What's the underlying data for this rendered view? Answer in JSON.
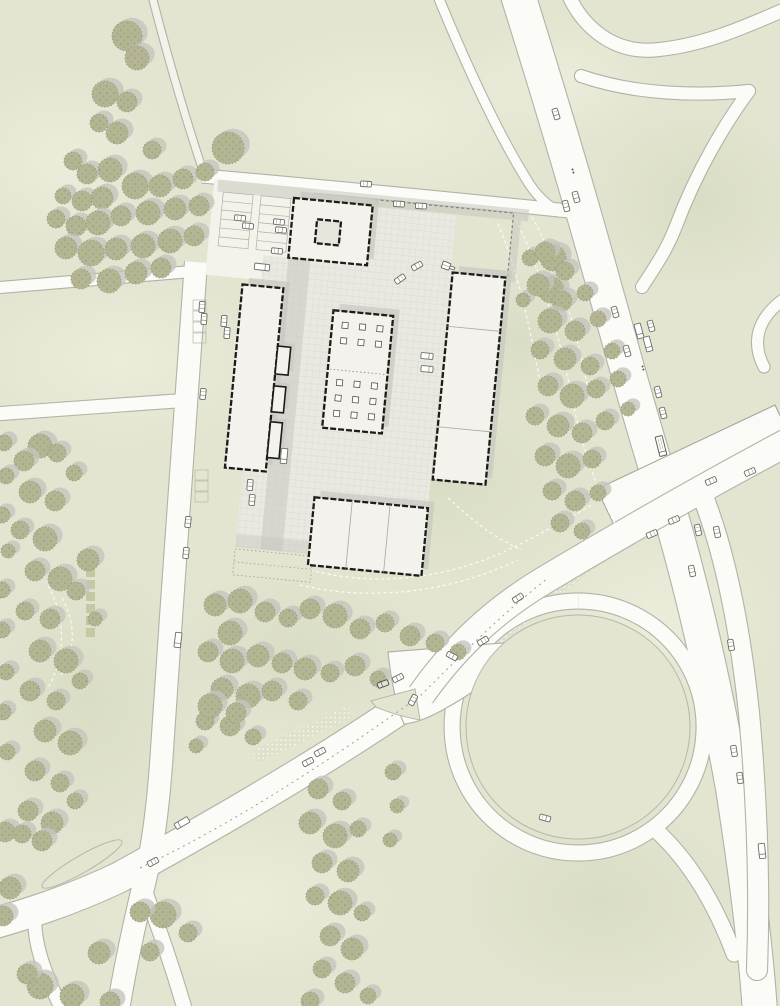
{
  "meta": {
    "kind": "architectural-site-plan",
    "width": 780,
    "height": 1006
  },
  "colors": {
    "grass": "#e3e5d1",
    "grassLight": "#edeedd",
    "grassDark": "#d6d9bf",
    "roadFill": "#fbfbf8",
    "roadEdge": "#b2b2a7",
    "pathFill": "#f3f3eb",
    "plazaFill": "#e9e9e1",
    "plazaLine": "#d9d8cf",
    "grayStrip": "#c6c6be",
    "shadow": "#c8c8c0",
    "buildingFill": "#f3f2ec",
    "buildingEdge": "#1c1c1a",
    "innerLine": "#a9a9a0",
    "treeFill": "#b4b593",
    "treeDot": "#8b8d6e",
    "treeShadow": "#c5c4bd",
    "treeEdge": "#9a9c7e",
    "carFill": "#ffffff",
    "carEdge": "#6e6e66",
    "fence": "#85857d",
    "dashWhite": "#ffffff",
    "cobbleDot": "#f8f8f2",
    "islandEdge": "#b7b7ac",
    "deckFill": "#fafaf6",
    "deckEdge": "#a6a69c"
  },
  "mottle": {
    "light": [
      [
        390,
        120,
        170,
        90
      ],
      [
        120,
        360,
        150,
        85
      ],
      [
        660,
        620,
        120,
        90
      ],
      [
        240,
        900,
        150,
        80
      ],
      [
        560,
        80,
        95,
        60
      ],
      [
        60,
        160,
        110,
        90
      ]
    ],
    "dark": [
      [
        440,
        480,
        180,
        120
      ],
      [
        90,
        700,
        120,
        160
      ],
      [
        600,
        900,
        160,
        110
      ],
      [
        700,
        200,
        120,
        100
      ],
      [
        300,
        650,
        140,
        90
      ],
      [
        520,
        340,
        110,
        80
      ]
    ]
  },
  "cobble_bands": [
    {
      "d": "M 660,510 C 615,545 560,585 520,618 C 495,640 470,665 450,688",
      "w": 14
    },
    {
      "d": "M 350,712 C 318,728 285,742 255,757",
      "w": 13
    }
  ],
  "roads": [
    {
      "name": "highway-main",
      "layer": 1,
      "d": "M 517,-8 C 543,75 572,170 603,282 C 622,350 645,435 668,506 C 690,580 712,672 733,788 C 747,878 756,952 760,1012",
      "w": 34
    },
    {
      "name": "service-road",
      "layer": 1,
      "d": "M 437,-6 C 460,50 495,130 530,185 C 541,201 551,208 562,213",
      "w": 9
    },
    {
      "name": "ramp-s-curve",
      "layer": 1,
      "d": "M 568,-6 C 583,28 614,53 654,50 C 704,46 749,25 786,9",
      "w": 13
    },
    {
      "name": "ramp-east-upper",
      "layer": 1,
      "cap": "round",
      "d": "M 581,76 C 636,95 700,96 749,91",
      "w": 12
    },
    {
      "name": "ramp-east-lower",
      "layer": 1,
      "cap": "round",
      "d": "M 749,91 C 726,122 697,170 676,226 C 666,252 654,268 642,287",
      "w": 12
    },
    {
      "name": "ramp-edge-blip",
      "layer": 1,
      "cap": "round",
      "d": "M 787,297 C 757,317 751,342 764,367",
      "w": 11
    },
    {
      "name": "access-road-north",
      "layer": 1,
      "d": "M 202,176 C 320,186 450,199 569,211",
      "w": 13
    },
    {
      "name": "footpath-northwest",
      "layer": 1,
      "fillColor": "#f3f3eb",
      "d": "M 152,-4 C 168,58 186,120 204,174",
      "w": 7
    },
    {
      "name": "west-link-upper",
      "layer": 1,
      "d": "M -6,288 L 198,271",
      "w": 11
    },
    {
      "name": "west-link-lower",
      "layer": 1,
      "d": "M -6,414 L 190,400",
      "w": 13
    },
    {
      "name": "west-road",
      "layer": 1,
      "d": "M 196,262 C 188,390 173,580 162,750 C 158,812 152,852 143,888 C 133,930 125,968 118,1010",
      "w": 22
    },
    {
      "name": "south-fork-road",
      "layer": 1,
      "cap": "round",
      "d": "M 143,886 C 158,925 171,962 185,1010",
      "w": 14
    },
    {
      "name": "boulevard",
      "layer": 1,
      "d": "M 422,694 C 320,765 200,833 118,878 C 65,903 20,916 -8,924",
      "w": 30
    },
    {
      "name": "boulevard-corner-branch",
      "layer": 1,
      "cap": "round",
      "d": "M 36,905 C 30,940 46,975 62,1010",
      "w": 13
    },
    {
      "name": "ring-road",
      "layer": 1,
      "d": "M 578,601 a 126,126 0 1 0 0.2,0",
      "w": 15
    },
    {
      "name": "ring-exit-ramp",
      "layer": 1,
      "cap": "round",
      "d": "M 658,832 C 692,864 716,906 734,954",
      "w": 15
    },
    {
      "name": "fork-apron",
      "layer": 1,
      "type": "fill",
      "d": "M 388,652 L 540,640 C 516,662 478,690 448,707 C 431,717 416,723 404,724 C 397,708 391,681 388,652 Z"
    },
    {
      "name": "bridge-road",
      "layer": 2,
      "d": "M 788,442 C 700,489 618,536 543,581 C 490,613 452,651 421,695",
      "w": 27
    },
    {
      "name": "bridge-south-ramp",
      "layer": 2,
      "cap": "round",
      "d": "M 700,489 C 728,557 742,646 749,713 C 757,800 760,888 757,970",
      "w": 20
    }
  ],
  "bridge_deck": {
    "points": "597,489 775,405 793,443 615,527"
  },
  "islands": [
    {
      "type": "circle",
      "name": "loop-island",
      "cx": 578,
      "cy": 727,
      "r": 112
    },
    {
      "type": "ellipse",
      "name": "median-island",
      "cx": 82,
      "cy": 864,
      "rx": 46,
      "ry": 8.5,
      "rot": -30
    },
    {
      "type": "path",
      "name": "triangle-island",
      "d": "M 371,701 L 415,689 L 420,720 Q 394,715 376,707 Z"
    }
  ],
  "road_marks": [
    {
      "name": "boulevard-centerline",
      "d": "M 140,868 C 240,820 330,760 420,696 C 458,659 492,622 548,578",
      "dash": "2 4",
      "color": "#9f9f94",
      "w": 1
    }
  ],
  "decor_dashes": [
    {
      "d": "M 516,220 C 540,268 558,330 572,398 C 582,448 598,492 616,526"
    },
    {
      "d": "M 498,224 C 518,270 531,332 543,398"
    },
    {
      "d": "M 532,217 C 558,262 576,330 590,398"
    },
    {
      "d": "M 310,570 C 380,588 450,578 512,548 C 545,532 572,516 592,505"
    },
    {
      "d": "M 300,585 C 372,602 452,592 518,560"
    },
    {
      "d": "M 62,598 C 76,622 76,652 60,676"
    },
    {
      "d": "M 48,586 C 66,616 66,656 48,688"
    },
    {
      "d": "M 448,498 C 472,520 494,538 522,550"
    }
  ],
  "campus": {
    "rotation": 5.5,
    "cx": 380,
    "cy": 380,
    "pads": [
      [
        196,
        196,
        100,
        96
      ]
    ],
    "plaza_rects": [
      [
        356,
        207,
        84,
        60
      ],
      [
        252,
        267,
        188,
        240
      ],
      [
        252,
        460,
        76,
        100
      ]
    ],
    "gray_rects": [
      [
        200,
        196,
        312,
        12,
        0.55
      ],
      [
        497,
        208,
        8,
        62,
        0.5
      ],
      [
        277,
        267,
        22,
        293,
        0.5
      ],
      [
        252,
        547,
        78,
        13,
        0.45
      ]
    ],
    "fence_points": "358,201 497,201 497,265",
    "plot_rect": [
      252,
      562,
      78,
      26
    ],
    "buildings": [
      {
        "name": "north-courtyard-building",
        "x": 277,
        "y": 207,
        "w": 79,
        "h": 60
      },
      {
        "name": "north-courtyard-void",
        "x": 302,
        "y": 226,
        "w": 24,
        "h": 24,
        "fill": "#e7e6db",
        "noshadow": true
      },
      {
        "name": "west-slab-building",
        "x": 234,
        "y": 298,
        "w": 41,
        "h": 184
      },
      {
        "name": "central-pavilion",
        "x": 327,
        "y": 315,
        "w": 60,
        "h": 118
      },
      {
        "name": "east-slab-building",
        "x": 442,
        "y": 266,
        "w": 53,
        "h": 208,
        "inner_h": [
          320,
          421
        ]
      },
      {
        "name": "south-building",
        "x": 326,
        "y": 503,
        "w": 114,
        "h": 68,
        "inner_v": [
          364,
          402
        ]
      }
    ],
    "annexes": [
      [
        275,
        356,
        13,
        28
      ],
      [
        275,
        396,
        12,
        26
      ],
      [
        275,
        432,
        12,
        36
      ]
    ],
    "columns": {
      "xs": [
        337,
        354.5,
        372
      ],
      "ys_top": [
        326,
        341.5
      ],
      "ys_bot": [
        383.5,
        399,
        414.5
      ],
      "size": 6
    },
    "pavilion_divider": [
      329,
      374,
      385,
      374
    ],
    "parking_banks": [
      [
        206,
        208,
        30,
        54,
        6
      ],
      [
        244,
        208,
        30,
        54,
        6
      ]
    ],
    "hedges": [
      [
        86,
        556
      ],
      [
        86,
        568
      ],
      [
        86,
        580
      ],
      [
        86,
        592
      ],
      [
        86,
        604
      ],
      [
        86,
        616
      ],
      [
        86,
        628
      ]
    ],
    "bays": [
      [
        193,
        300
      ],
      [
        193,
        311
      ],
      [
        193,
        322
      ],
      [
        193,
        333
      ],
      [
        195,
        470
      ],
      [
        195,
        481
      ],
      [
        195,
        492
      ]
    ]
  },
  "trees": [
    [
      127,
      36,
      15
    ],
    [
      137,
      58,
      12
    ],
    [
      105,
      94,
      13
    ],
    [
      127,
      102,
      10
    ],
    [
      99,
      123,
      9
    ],
    [
      117,
      133,
      11
    ],
    [
      152,
      150,
      9
    ],
    [
      73,
      161,
      9
    ],
    [
      87,
      174,
      10
    ],
    [
      110,
      170,
      12
    ],
    [
      135,
      186,
      13
    ],
    [
      63,
      196,
      8
    ],
    [
      82,
      201,
      10
    ],
    [
      102,
      198,
      11
    ],
    [
      160,
      186,
      11
    ],
    [
      183,
      179,
      10
    ],
    [
      228,
      148,
      16
    ],
    [
      205,
      172,
      9
    ],
    [
      56,
      219,
      9
    ],
    [
      76,
      226,
      10
    ],
    [
      98,
      223,
      12
    ],
    [
      121,
      216,
      10
    ],
    [
      148,
      213,
      12
    ],
    [
      175,
      209,
      11
    ],
    [
      199,
      206,
      10
    ],
    [
      66,
      248,
      11
    ],
    [
      91,
      253,
      13
    ],
    [
      116,
      249,
      11
    ],
    [
      143,
      246,
      12
    ],
    [
      170,
      241,
      12
    ],
    [
      194,
      236,
      10
    ],
    [
      81,
      279,
      10
    ],
    [
      109,
      281,
      12
    ],
    [
      136,
      273,
      11
    ],
    [
      161,
      268,
      10
    ],
    [
      40,
      446,
      12
    ],
    [
      24,
      461,
      10
    ],
    [
      57,
      453,
      9
    ],
    [
      30,
      492,
      11
    ],
    [
      55,
      501,
      10
    ],
    [
      20,
      530,
      9
    ],
    [
      45,
      539,
      12
    ],
    [
      74,
      473,
      8
    ],
    [
      88,
      560,
      11
    ],
    [
      35,
      571,
      10
    ],
    [
      60,
      579,
      12
    ],
    [
      25,
      611,
      9
    ],
    [
      50,
      619,
      10
    ],
    [
      76,
      591,
      9
    ],
    [
      95,
      619,
      7
    ],
    [
      40,
      651,
      11
    ],
    [
      66,
      661,
      12
    ],
    [
      30,
      691,
      10
    ],
    [
      56,
      701,
      9
    ],
    [
      80,
      681,
      8
    ],
    [
      45,
      731,
      11
    ],
    [
      70,
      743,
      12
    ],
    [
      35,
      771,
      10
    ],
    [
      60,
      783,
      9
    ],
    [
      28,
      811,
      10
    ],
    [
      52,
      823,
      11
    ],
    [
      75,
      801,
      8
    ],
    [
      5,
      832,
      10
    ],
    [
      22,
      834,
      9
    ],
    [
      42,
      841,
      10
    ],
    [
      10,
      888,
      11
    ],
    [
      3,
      916,
      10
    ],
    [
      4,
      443,
      8
    ],
    [
      6,
      476,
      8
    ],
    [
      2,
      515,
      8
    ],
    [
      8,
      551,
      7
    ],
    [
      2,
      590,
      8
    ],
    [
      2,
      630,
      8
    ],
    [
      6,
      672,
      8
    ],
    [
      3,
      712,
      8
    ],
    [
      7,
      752,
      8
    ],
    [
      215,
      605,
      11
    ],
    [
      240,
      601,
      12
    ],
    [
      265,
      612,
      10
    ],
    [
      230,
      633,
      12
    ],
    [
      288,
      618,
      9
    ],
    [
      310,
      609,
      10
    ],
    [
      335,
      616,
      12
    ],
    [
      360,
      629,
      10
    ],
    [
      385,
      623,
      9
    ],
    [
      410,
      636,
      10
    ],
    [
      435,
      643,
      9
    ],
    [
      458,
      652,
      8
    ],
    [
      208,
      652,
      10
    ],
    [
      232,
      661,
      12
    ],
    [
      258,
      656,
      11
    ],
    [
      282,
      663,
      10
    ],
    [
      305,
      669,
      11
    ],
    [
      330,
      673,
      9
    ],
    [
      355,
      666,
      10
    ],
    [
      378,
      679,
      8
    ],
    [
      222,
      689,
      11
    ],
    [
      248,
      696,
      12
    ],
    [
      272,
      691,
      10
    ],
    [
      298,
      701,
      9
    ],
    [
      205,
      721,
      9
    ],
    [
      230,
      726,
      10
    ],
    [
      253,
      737,
      8
    ],
    [
      196,
      746,
      7
    ],
    [
      210,
      706,
      12
    ],
    [
      236,
      713,
      10
    ],
    [
      553,
      258,
      13
    ],
    [
      551,
      290,
      13
    ],
    [
      530,
      258,
      8
    ],
    [
      523,
      300,
      7
    ],
    [
      545,
      252,
      10
    ],
    [
      565,
      271,
      9
    ],
    [
      538,
      285,
      11
    ],
    [
      562,
      301,
      10
    ],
    [
      585,
      293,
      8
    ],
    [
      550,
      321,
      12
    ],
    [
      575,
      331,
      10
    ],
    [
      598,
      319,
      8
    ],
    [
      540,
      350,
      9
    ],
    [
      565,
      359,
      11
    ],
    [
      590,
      366,
      9
    ],
    [
      612,
      351,
      8
    ],
    [
      548,
      386,
      10
    ],
    [
      572,
      396,
      12
    ],
    [
      596,
      389,
      9
    ],
    [
      618,
      379,
      8
    ],
    [
      535,
      416,
      9
    ],
    [
      558,
      426,
      11
    ],
    [
      582,
      433,
      10
    ],
    [
      605,
      421,
      9
    ],
    [
      628,
      409,
      7
    ],
    [
      545,
      456,
      10
    ],
    [
      568,
      466,
      12
    ],
    [
      592,
      459,
      9
    ],
    [
      552,
      491,
      9
    ],
    [
      575,
      501,
      10
    ],
    [
      598,
      493,
      8
    ],
    [
      560,
      523,
      9
    ],
    [
      582,
      531,
      8
    ],
    [
      318,
      789,
      10
    ],
    [
      342,
      801,
      9
    ],
    [
      310,
      823,
      11
    ],
    [
      335,
      836,
      12
    ],
    [
      358,
      829,
      8
    ],
    [
      322,
      863,
      10
    ],
    [
      348,
      871,
      11
    ],
    [
      315,
      896,
      9
    ],
    [
      340,
      903,
      12
    ],
    [
      362,
      913,
      8
    ],
    [
      330,
      936,
      10
    ],
    [
      352,
      949,
      11
    ],
    [
      322,
      969,
      9
    ],
    [
      345,
      983,
      10
    ],
    [
      368,
      996,
      8
    ],
    [
      310,
      1001,
      9
    ],
    [
      393,
      772,
      8
    ],
    [
      397,
      806,
      7
    ],
    [
      390,
      840,
      7
    ],
    [
      163,
      915,
      13
    ],
    [
      188,
      933,
      9
    ],
    [
      99,
      953,
      11
    ],
    [
      40,
      986,
      13
    ],
    [
      72,
      996,
      12
    ],
    [
      110,
      1002,
      10
    ],
    [
      140,
      912,
      10
    ],
    [
      150,
      952,
      9
    ],
    [
      27,
      974,
      10
    ]
  ],
  "vehicles": [
    [
      366,
      184,
      4,
      "car"
    ],
    [
      399,
      204,
      4,
      "car"
    ],
    [
      421,
      206,
      4,
      "car"
    ],
    [
      566,
      206,
      75,
      "car"
    ],
    [
      556,
      114,
      73,
      "car"
    ],
    [
      573,
      171,
      73,
      "moto"
    ],
    [
      576,
      197,
      74,
      "car"
    ],
    [
      615,
      312,
      74,
      "car"
    ],
    [
      651,
      326,
      74,
      "car"
    ],
    [
      639,
      331,
      75,
      "truck"
    ],
    [
      648,
      344,
      75,
      "truck"
    ],
    [
      627,
      351,
      74,
      "car"
    ],
    [
      658,
      392,
      75,
      "car"
    ],
    [
      663,
      413,
      75,
      "car"
    ],
    [
      661,
      446,
      76,
      "truckBig"
    ],
    [
      643,
      368,
      74,
      "moto"
    ],
    [
      692,
      571,
      78,
      "car"
    ],
    [
      698,
      530,
      78,
      "car"
    ],
    [
      717,
      532,
      78,
      "car"
    ],
    [
      731,
      645,
      80,
      "car"
    ],
    [
      734,
      751,
      81,
      "car"
    ],
    [
      740,
      778,
      82,
      "car"
    ],
    [
      762,
      851,
      84,
      "truck"
    ],
    [
      711,
      481,
      156,
      "car"
    ],
    [
      750,
      472,
      156,
      "car"
    ],
    [
      674,
      520,
      156,
      "car"
    ],
    [
      652,
      534,
      156,
      "car"
    ],
    [
      518,
      598,
      147,
      "car"
    ],
    [
      483,
      641,
      149,
      "car"
    ],
    [
      398,
      678,
      153,
      "car"
    ],
    [
      383,
      684,
      160,
      "carDark"
    ],
    [
      413,
      700,
      118,
      "car"
    ],
    [
      452,
      656,
      28,
      "car"
    ],
    [
      545,
      818,
      15,
      "car"
    ],
    [
      320,
      752,
      152,
      "car"
    ],
    [
      308,
      762,
      152,
      "car"
    ],
    [
      182,
      823,
      150,
      "truck"
    ],
    [
      153,
      862,
      152,
      "car"
    ],
    [
      203,
      394,
      96,
      "car"
    ],
    [
      188,
      522,
      96,
      "car"
    ],
    [
      186,
      553,
      96,
      "car"
    ],
    [
      178,
      640,
      97,
      "truck"
    ],
    [
      202,
      307,
      94,
      "car"
    ],
    [
      204,
      319,
      94,
      "car"
    ],
    [
      224,
      321,
      94,
      "car"
    ],
    [
      227,
      333,
      94,
      "car"
    ],
    [
      250,
      485,
      95,
      "car"
    ],
    [
      252,
      500,
      95,
      "car"
    ],
    [
      240,
      218,
      6,
      "car"
    ],
    [
      248,
      226,
      6,
      "car"
    ],
    [
      279,
      222,
      6,
      "car"
    ],
    [
      281,
      230,
      6,
      "car"
    ],
    [
      277,
      251,
      6,
      "car"
    ],
    [
      262,
      267,
      6,
      "truck"
    ],
    [
      400,
      279,
      145,
      "car"
    ],
    [
      417,
      266,
      150,
      "car"
    ],
    [
      447,
      266,
      20,
      "digger"
    ],
    [
      427,
      356,
      5,
      "van"
    ],
    [
      427,
      369,
      5,
      "van"
    ],
    [
      284,
      456,
      95,
      "truck"
    ]
  ]
}
